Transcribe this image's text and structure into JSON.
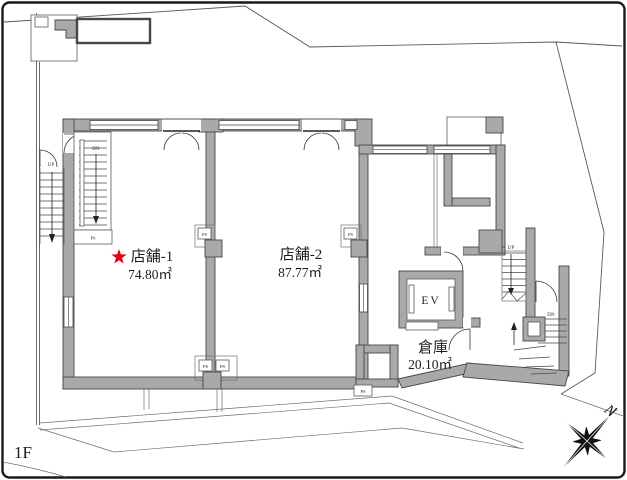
{
  "floor_plan": {
    "floor_label": "1F",
    "rooms": [
      {
        "id": "shop1",
        "name": "店舗-1",
        "area": "74.80㎡",
        "starred": true
      },
      {
        "id": "shop2",
        "name": "店舗-2",
        "area": "87.77㎡",
        "starred": false
      },
      {
        "id": "warehouse",
        "name": "倉庫",
        "area": "20.10㎡",
        "starred": false
      },
      {
        "id": "elevator",
        "name": "EV"
      }
    ],
    "stair_labels": {
      "up": "UP",
      "down": "DN"
    },
    "shaft_label": "PS",
    "compass_label": "N",
    "icons": {
      "highlight_star": "★",
      "compass_rose": "eight-point-star"
    },
    "colors": {
      "wall_fill": "#a9a9a9",
      "wall_outline": "#474747",
      "star_red": "#e60012",
      "background": "#ffffff",
      "boundary_line": "#595959"
    }
  }
}
